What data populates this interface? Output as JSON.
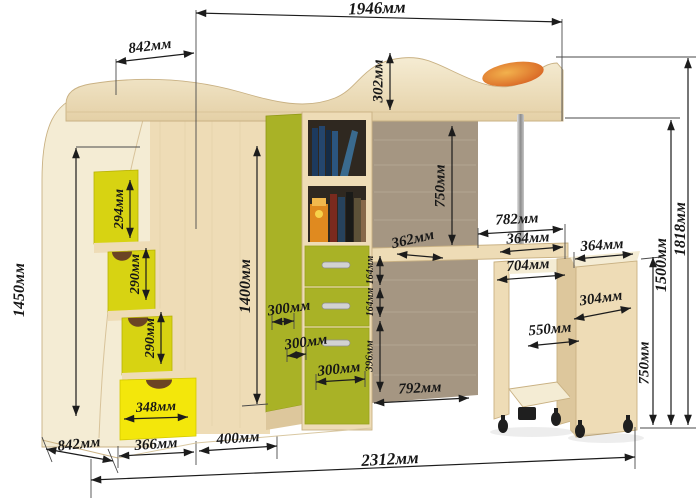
{
  "title": "Loft bed with wardrobe, stairs and pull-out desk — dimension diagram",
  "units": "мм",
  "colors": {
    "background": "#ffffff",
    "text": "#161616",
    "dim_line": "#1c1c1c",
    "wood": "#eedcb6",
    "wood_light": "#f4ecd4",
    "wood_dark": "#ddc79c",
    "wood_edge": "#c9b183",
    "green": "#a9b226",
    "green_dark": "#8f9714",
    "yellow_step": "#d7d312",
    "yellow_bright": "#f3e70b",
    "taupe": "#a59682",
    "taupe_light": "#bcae9a",
    "orange": "#e07a26",
    "orange_light": "#f2b14d",
    "metal": "#b9b9b9",
    "caster": "#1f1f1f",
    "notch_brown": "#6b4424",
    "shelf_interior": "#2f2820",
    "handle": "#d2d2d2"
  },
  "dimensions": [
    {
      "id": "bed-top-width",
      "text": "1946мм",
      "x": 377,
      "y": 8,
      "rot": -2,
      "size": 17
    },
    {
      "id": "top-left-depth",
      "text": "842мм",
      "x": 150,
      "y": 47,
      "rot": -7,
      "size": 15
    },
    {
      "id": "bed-rail-height",
      "text": "302мм",
      "x": 379,
      "y": 81,
      "rot": -90,
      "size": 15
    },
    {
      "id": "left-unit-height",
      "text": "1450мм",
      "x": 20,
      "y": 290,
      "rot": -90,
      "size": 16
    },
    {
      "id": "step1-height",
      "text": "294мм",
      "x": 120,
      "y": 209,
      "rot": -90,
      "size": 14
    },
    {
      "id": "step2-height",
      "text": "290мм",
      "x": 136,
      "y": 274,
      "rot": -90,
      "size": 14
    },
    {
      "id": "step3-height",
      "text": "290мм",
      "x": 151,
      "y": 338,
      "rot": -90,
      "size": 14
    },
    {
      "id": "stair-drawer-width",
      "text": "348мм",
      "x": 156,
      "y": 408,
      "rot": -3,
      "size": 14
    },
    {
      "id": "bottom-left-depth",
      "text": "842мм",
      "x": 79,
      "y": 445,
      "rot": -6,
      "size": 15
    },
    {
      "id": "stair-base-width",
      "text": "366мм",
      "x": 156,
      "y": 445,
      "rot": -4,
      "size": 15
    },
    {
      "id": "wardrobe-base-width",
      "text": "400мм",
      "x": 238,
      "y": 439,
      "rot": -4,
      "size": 15
    },
    {
      "id": "total-width",
      "text": "2312мм",
      "x": 390,
      "y": 459,
      "rot": -3,
      "size": 17
    },
    {
      "id": "wardrobe-height",
      "text": "1400мм",
      "x": 246,
      "y": 286,
      "rot": -90,
      "size": 16
    },
    {
      "id": "wardrobe-section-1",
      "text": "300мм",
      "x": 289,
      "y": 309,
      "rot": -8,
      "size": 15
    },
    {
      "id": "wardrobe-section-2",
      "text": "300мм",
      "x": 306,
      "y": 343,
      "rot": -8,
      "size": 15
    },
    {
      "id": "wardrobe-section-3",
      "text": "300мм",
      "x": 339,
      "y": 370,
      "rot": -6,
      "size": 15
    },
    {
      "id": "under-bed-clearance",
      "text": "750мм",
      "x": 441,
      "y": 186,
      "rot": -90,
      "size": 15
    },
    {
      "id": "desk-depth",
      "text": "362мм",
      "x": 413,
      "y": 240,
      "rot": -13,
      "size": 15
    },
    {
      "id": "shelf-drawer1-height",
      "text": "164мм",
      "x": 371,
      "y": 270,
      "rot": -90,
      "size": 10
    },
    {
      "id": "shelf-drawer2-height",
      "text": "164мм",
      "x": 371,
      "y": 302,
      "rot": -90,
      "size": 10
    },
    {
      "id": "shelf-door-height",
      "text": "396мм",
      "x": 370,
      "y": 356,
      "rot": -90,
      "size": 11
    },
    {
      "id": "back-panel-width",
      "text": "792мм",
      "x": 420,
      "y": 389,
      "rot": -3,
      "size": 15
    },
    {
      "id": "desk-width",
      "text": "782мм",
      "x": 517,
      "y": 220,
      "rot": -3,
      "size": 15
    },
    {
      "id": "desk-section-width",
      "text": "364мм",
      "x": 528,
      "y": 239,
      "rot": -3,
      "size": 15
    },
    {
      "id": "table-inner-width",
      "text": "704мм",
      "x": 528,
      "y": 266,
      "rot": -4,
      "size": 15
    },
    {
      "id": "table-depth",
      "text": "550мм",
      "x": 550,
      "y": 330,
      "rot": -5,
      "size": 15
    },
    {
      "id": "pedestal-depth",
      "text": "304мм",
      "x": 601,
      "y": 299,
      "rot": -8,
      "size": 15
    },
    {
      "id": "pedestal-width",
      "text": "364мм",
      "x": 602,
      "y": 246,
      "rot": -4,
      "size": 15
    },
    {
      "id": "pedestal-height",
      "text": "750мм",
      "x": 645,
      "y": 363,
      "rot": -90,
      "size": 15
    },
    {
      "id": "bed-platform-height",
      "text": "1500мм",
      "x": 662,
      "y": 265,
      "rot": -90,
      "size": 16
    },
    {
      "id": "total-height",
      "text": "1818мм",
      "x": 681,
      "y": 229,
      "rot": -90,
      "size": 16
    }
  ]
}
